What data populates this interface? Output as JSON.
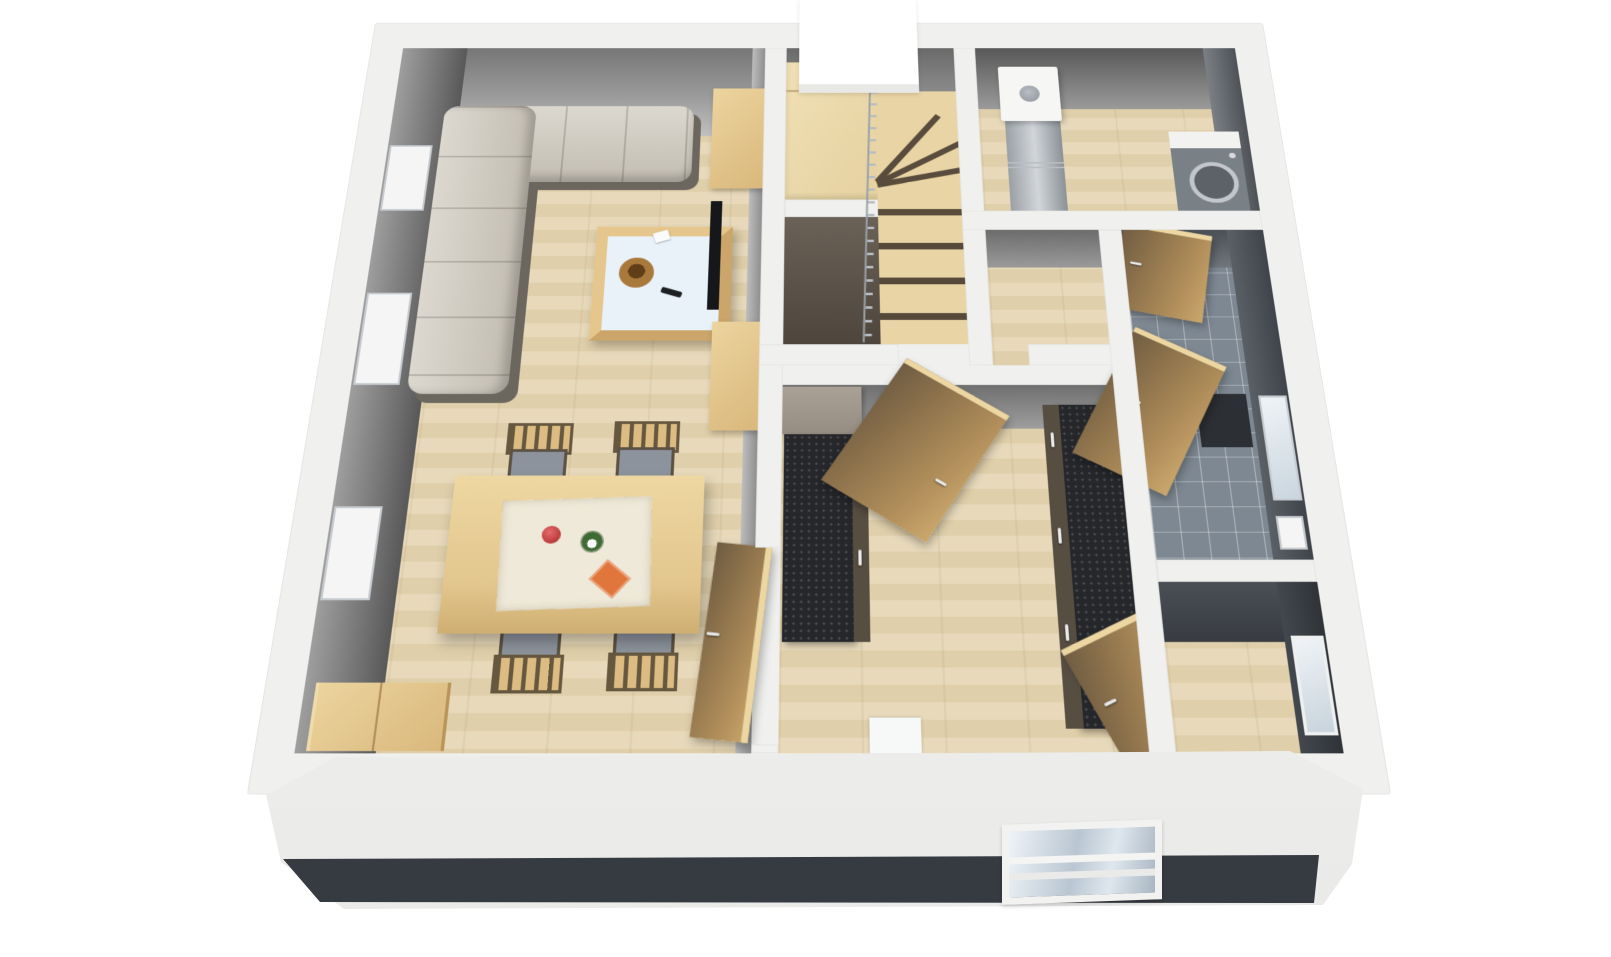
{
  "meta": {
    "type": "3d-floor-plan-rendering",
    "view": "perspective-dollhouse-top-view",
    "background_color": "#ffffff",
    "visible_text": ""
  },
  "palette": {
    "exterior_wall_cut": "#f0f0ee",
    "front_wall_face": "#f4f4f2",
    "plinth_dark": "#363b42",
    "interior_wall_face_gray": "#8a8a8a",
    "wood_floor_light": "#e4d5b4",
    "oak_furniture": "#ddbd84",
    "door_wood": "#b3905c",
    "kitchen_counter_black": "#25272b",
    "kitchen_cabinet_brown": "#574e42",
    "sofa_gray": "#cbc6bc",
    "bathroom_tile_gray": "#7e8892",
    "metal_gray": "#aab0b6",
    "window_glass": "#dce6ee",
    "accent_red_bowl": "#b93a3a",
    "accent_orange_mat": "#e0763c",
    "plant_green": "#3e6b34",
    "stair_riser_dark": "#5a4c3c"
  },
  "rooms": [
    {
      "name": "living-dining-area",
      "floor": "light-wood-planks"
    },
    {
      "name": "stairwell",
      "floor": "wood-with-winder-stairs"
    },
    {
      "name": "utility-room",
      "floor": "light-wood-planks"
    },
    {
      "name": "corridor",
      "floor": "light-wood-planks"
    },
    {
      "name": "kitchen",
      "floor": "light-wood-planks"
    },
    {
      "name": "bathroom",
      "floor": "gray-tiles"
    },
    {
      "name": "storage-room",
      "floor": "light-wood-planks"
    }
  ],
  "furniture": [
    "corner-sofa-gray",
    "coffee-table-glass-top",
    "wooden-bowl",
    "tv-remote",
    "dining-table",
    "table-runner",
    "red-fruit-bowl",
    "potted-plant",
    "orange-placemat",
    "dining-chair-1",
    "dining-chair-2",
    "dining-chair-3",
    "dining-chair-4",
    "sideboard",
    "tv-cabinet-upper",
    "tv-cabinet-lower",
    "television",
    "winder-staircase",
    "stair-railing",
    "chimney-shaft",
    "water-heater-boiler",
    "washing-machine",
    "kitchen-tall-cabinet",
    "kitchen-counter-left",
    "kitchen-counter-right",
    "kitchen-sink-unit",
    "bathroom-vanity"
  ],
  "openings": {
    "interior_door_leaves": 5,
    "windows_left_wall": 3,
    "windows_right_wall": 2,
    "windows_front_wall": 1
  }
}
